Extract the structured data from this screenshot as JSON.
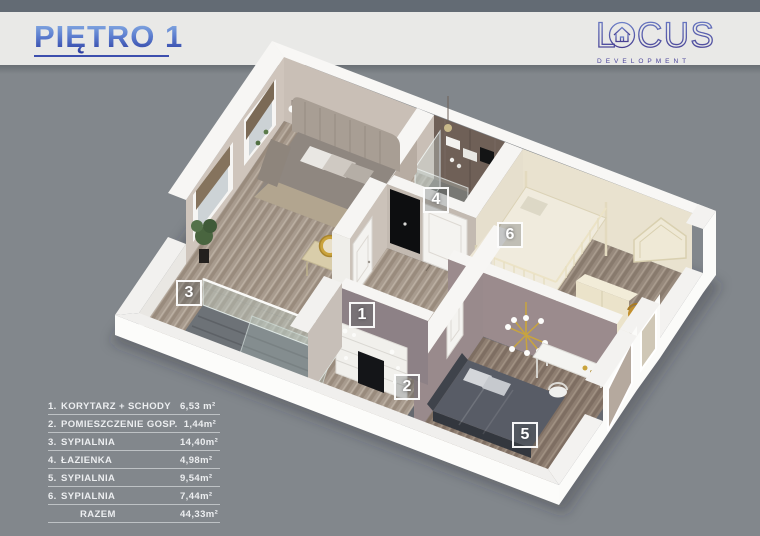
{
  "header": {
    "title": "PIĘTRO 1"
  },
  "logo": {
    "part1": "L",
    "part2": "CUS",
    "subtitle": "DEVELOPMENT"
  },
  "legend": {
    "items": [
      {
        "num": "1.",
        "label": "KORYTARZ + SCHODY",
        "area": "6,53 m²"
      },
      {
        "num": "2.",
        "label": "POMIESZCZENIE GOSP.",
        "area": "1,44m²"
      },
      {
        "num": "3.",
        "label": "SYPIALNIA",
        "area": "14,40m²"
      },
      {
        "num": "4.",
        "label": "ŁAZIENKA",
        "area": "4,98m²"
      },
      {
        "num": "5.",
        "label": "SYPIALNIA",
        "area": "9,54m²"
      },
      {
        "num": "6.",
        "label": "SYPIALNIA",
        "area": "7,44m²"
      }
    ],
    "total": {
      "label": "RAZEM",
      "area": "44,33m²"
    }
  },
  "plan": {
    "room_labels": [
      {
        "num": "1",
        "x": 362,
        "y": 315
      },
      {
        "num": "2",
        "x": 407,
        "y": 387
      },
      {
        "num": "3",
        "x": 189,
        "y": 293
      },
      {
        "num": "4",
        "x": 436,
        "y": 200
      },
      {
        "num": "5",
        "x": 525,
        "y": 435
      },
      {
        "num": "6",
        "x": 510,
        "y": 235
      }
    ]
  },
  "colors": {
    "background": "#82878c",
    "top_strip": "#636b74",
    "banner": "#e9e9e7",
    "title_gradient_top": "#96bde9",
    "title_gradient_bottom": "#27379d",
    "title_underline": "#3d4fae",
    "logo_gradient_top": "#6b7ec7",
    "logo_gradient_bottom": "#473e91"
  }
}
